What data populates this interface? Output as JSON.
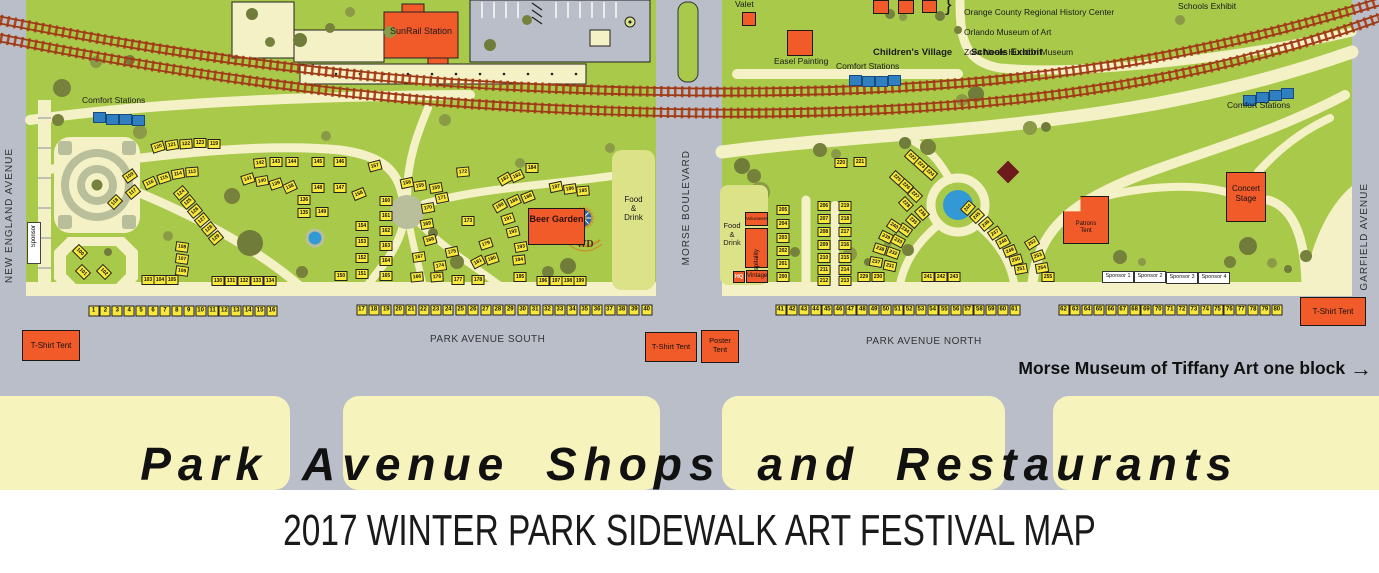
{
  "banner": "Park Avenue Shops and Restaurants",
  "subtitle": "2017 WINTER PARK SIDEWALK ART FESTIVAL MAP",
  "streets": {
    "new_england": "NEW ENGLAND AVENUE",
    "morse": "MORSE BOULEVARD",
    "garfield": "GARFIELD AVENUE",
    "park_south": "PARK AVENUE SOUTH",
    "park_north": "PARK AVENUE NORTH"
  },
  "note": {
    "text": "Morse Museum of Tiffany Art one block",
    "arrow": "→"
  },
  "museums": {
    "brace": "}",
    "line1": "Orange County Regional History Center",
    "line2": "Orlando Museum of Art",
    "line3": "Zora Neale Hurston Museum"
  },
  "labels": {
    "sunrail": "SunRail Station",
    "comfort": "Comfort Stations",
    "valet": "Valet",
    "easel": "Easel Painting",
    "childrens_village": "Children's Village",
    "schools_exhibit": "Schools Exhibit",
    "beer_garden": "Beer Garden",
    "wd": "WD",
    "food_drink": "Food\n&\nDrink",
    "volunteers": "Volunteers",
    "hospitality": "Hospitality",
    "hq": "HQ",
    "vintage": "Vintage",
    "patrons_tent": "Patrons\nTent",
    "concert_stage": "Concert\nStage",
    "tshirt_tent": "T-Shirt Tent",
    "poster_tent": "Poster\nTent",
    "sponsor_vertical": "Sponsor",
    "sponsors": [
      "Sponsor 1",
      "Sponsor 2",
      "Sponsor 3",
      "Sponsor 4"
    ]
  },
  "street_booths": [
    {
      "x": 93.5,
      "y": 311,
      "step": 11.9,
      "numbers": [
        1,
        2,
        3,
        4,
        5,
        6,
        7,
        8,
        9,
        10,
        11,
        12,
        13,
        14,
        15,
        16
      ]
    },
    {
      "x": 361.5,
      "y": 310,
      "step": 12.4,
      "numbers": [
        17,
        18,
        19,
        20,
        21,
        22,
        23,
        24,
        25,
        26,
        27,
        28,
        29,
        30,
        31,
        32,
        33,
        34,
        35,
        36,
        37,
        38,
        39,
        40
      ]
    },
    {
      "x": 780.5,
      "y": 310,
      "step": 11.7,
      "numbers": [
        41,
        42,
        43,
        44,
        45,
        46,
        47,
        48,
        49,
        50,
        51,
        52,
        53,
        54,
        55,
        56,
        57,
        58,
        59,
        60,
        61
      ]
    },
    {
      "x": 1063.5,
      "y": 310,
      "step": 11.85,
      "numbers": [
        62,
        63,
        64,
        65,
        66,
        67,
        68,
        69,
        70,
        71,
        72,
        73,
        74,
        75,
        76,
        77,
        78,
        79,
        80
      ]
    }
  ],
  "park_booths": [
    [
      100,
      80,
      252,
      45
    ],
    [
      101,
      83,
      272,
      45
    ],
    [
      102,
      104,
      272,
      45
    ],
    [
      103,
      148,
      280,
      0
    ],
    [
      104,
      160,
      280,
      0
    ],
    [
      105,
      172,
      280,
      0
    ],
    [
      106,
      182,
      271,
      8
    ],
    [
      107,
      182,
      259,
      8
    ],
    [
      108,
      182,
      247,
      8
    ],
    [
      109,
      130,
      176,
      -35
    ],
    [
      117,
      133,
      192,
      -40
    ],
    [
      118,
      115,
      202,
      -45
    ],
    [
      116,
      150,
      183,
      -25
    ],
    [
      115,
      164,
      178,
      -18
    ],
    [
      114,
      178,
      174,
      -10
    ],
    [
      113,
      192,
      172,
      -4
    ],
    [
      120,
      158,
      147,
      -18
    ],
    [
      121,
      172,
      145,
      -10
    ],
    [
      122,
      186,
      144,
      -4
    ],
    [
      123,
      200,
      143,
      0
    ],
    [
      119,
      214,
      144,
      0
    ],
    [
      124,
      181,
      193,
      -40
    ],
    [
      125,
      188,
      202,
      -40
    ],
    [
      126,
      195,
      211,
      -40
    ],
    [
      127,
      202,
      220,
      -40
    ],
    [
      128,
      209,
      229,
      -40
    ],
    [
      129,
      216,
      238,
      -40
    ],
    [
      130,
      218,
      281,
      0
    ],
    [
      131,
      231,
      281,
      0
    ],
    [
      132,
      244,
      281,
      0
    ],
    [
      133,
      257,
      281,
      0
    ],
    [
      134,
      270,
      281,
      0
    ],
    [
      141,
      248,
      179,
      -18
    ],
    [
      140,
      262,
      181,
      -10
    ],
    [
      139,
      276,
      184,
      -18
    ],
    [
      138,
      290,
      187,
      -25
    ],
    [
      142,
      260,
      163,
      -6
    ],
    [
      143,
      276,
      162,
      0
    ],
    [
      144,
      292,
      162,
      0
    ],
    [
      145,
      318,
      162,
      0
    ],
    [
      146,
      340,
      162,
      0
    ],
    [
      148,
      318,
      188,
      0
    ],
    [
      147,
      340,
      188,
      0
    ],
    [
      136,
      304,
      200,
      0
    ],
    [
      135,
      304,
      213,
      0
    ],
    [
      149,
      322,
      212,
      0
    ],
    [
      150,
      341,
      276,
      0
    ],
    [
      151,
      362,
      274,
      0
    ],
    [
      152,
      362,
      258,
      0
    ],
    [
      153,
      362,
      242,
      0
    ],
    [
      154,
      362,
      226,
      0
    ],
    [
      155,
      420,
      186,
      -8
    ],
    [
      156,
      407,
      183,
      -12
    ],
    [
      157,
      375,
      166,
      -15
    ],
    [
      158,
      359,
      194,
      -22
    ],
    [
      159,
      436,
      188,
      -10
    ],
    [
      160,
      386,
      201,
      0
    ],
    [
      161,
      386,
      216,
      0
    ],
    [
      162,
      386,
      231,
      0
    ],
    [
      163,
      386,
      246,
      0
    ],
    [
      164,
      386,
      261,
      0
    ],
    [
      165,
      386,
      276,
      0
    ],
    [
      166,
      417,
      277,
      -5
    ],
    [
      167,
      419,
      257,
      -8
    ],
    [
      168,
      430,
      240,
      -15
    ],
    [
      169,
      427,
      224,
      -10
    ],
    [
      170,
      428,
      208,
      -10
    ],
    [
      171,
      442,
      198,
      -12
    ],
    [
      172,
      463,
      172,
      -5
    ],
    [
      173,
      468,
      221,
      0
    ],
    [
      174,
      440,
      266,
      -8
    ],
    [
      175,
      452,
      252,
      -12
    ],
    [
      176,
      437,
      277,
      -4
    ],
    [
      177,
      458,
      280,
      0
    ],
    [
      178,
      478,
      280,
      0
    ],
    [
      179,
      486,
      244,
      -18
    ],
    [
      180,
      492,
      259,
      -18
    ],
    [
      181,
      478,
      262,
      -28
    ],
    [
      182,
      505,
      179,
      -30
    ],
    [
      183,
      517,
      176,
      -25
    ],
    [
      184,
      532,
      168,
      0
    ],
    [
      187,
      556,
      187,
      -12
    ],
    [
      186,
      570,
      189,
      -8
    ],
    [
      185,
      583,
      191,
      -5
    ],
    [
      190,
      500,
      206,
      -30
    ],
    [
      189,
      514,
      201,
      -25
    ],
    [
      188,
      528,
      197,
      -22
    ],
    [
      191,
      508,
      219,
      -18
    ],
    [
      192,
      513,
      232,
      -14
    ],
    [
      193,
      521,
      247,
      -10
    ],
    [
      194,
      519,
      260,
      -6
    ],
    [
      195,
      520,
      277,
      0
    ],
    [
      196,
      543,
      281,
      0
    ],
    [
      197,
      556,
      281,
      0
    ],
    [
      198,
      568,
      281,
      0
    ],
    [
      199,
      580,
      281,
      0
    ],
    [
      200,
      783,
      277,
      0
    ],
    [
      201,
      783,
      264,
      0
    ],
    [
      202,
      783,
      251,
      0
    ],
    [
      203,
      783,
      238,
      0
    ],
    [
      204,
      783,
      224,
      0
    ],
    [
      205,
      783,
      210,
      0
    ],
    [
      206,
      824,
      206,
      0
    ],
    [
      207,
      824,
      219,
      0
    ],
    [
      208,
      824,
      232,
      0
    ],
    [
      209,
      824,
      245,
      0
    ],
    [
      210,
      824,
      258,
      0
    ],
    [
      211,
      824,
      270,
      0
    ],
    [
      212,
      824,
      281,
      0
    ],
    [
      213,
      845,
      281,
      0
    ],
    [
      214,
      845,
      270,
      0
    ],
    [
      215,
      845,
      258,
      0
    ],
    [
      216,
      845,
      245,
      0
    ],
    [
      217,
      845,
      232,
      0
    ],
    [
      218,
      845,
      219,
      0
    ],
    [
      219,
      845,
      206,
      0
    ],
    [
      220,
      841,
      163,
      0
    ],
    [
      221,
      860,
      162,
      0
    ],
    [
      222,
      912,
      157,
      42
    ],
    [
      223,
      921,
      165,
      42
    ],
    [
      224,
      930,
      173,
      42
    ],
    [
      225,
      897,
      178,
      42
    ],
    [
      226,
      906,
      186,
      42
    ],
    [
      227,
      915,
      195,
      44
    ],
    [
      228,
      906,
      204,
      46
    ],
    [
      229,
      864,
      277,
      0
    ],
    [
      230,
      878,
      277,
      0
    ],
    [
      231,
      890,
      266,
      12
    ],
    [
      232,
      893,
      253,
      20
    ],
    [
      233,
      898,
      241,
      28
    ],
    [
      234,
      905,
      230,
      36
    ],
    [
      235,
      913,
      221,
      42
    ],
    [
      236,
      922,
      213,
      48
    ],
    [
      237,
      876,
      262,
      10
    ],
    [
      238,
      880,
      249,
      18
    ],
    [
      239,
      886,
      237,
      26
    ],
    [
      240,
      894,
      226,
      34
    ],
    [
      241,
      928,
      277,
      0
    ],
    [
      242,
      941,
      277,
      0
    ],
    [
      243,
      954,
      277,
      0
    ],
    [
      244,
      968,
      208,
      -48
    ],
    [
      245,
      977,
      216,
      -44
    ],
    [
      246,
      986,
      224,
      -40
    ],
    [
      247,
      995,
      233,
      -34
    ],
    [
      248,
      1003,
      242,
      -28
    ],
    [
      249,
      1010,
      251,
      -22
    ],
    [
      250,
      1016,
      260,
      -16
    ],
    [
      251,
      1021,
      269,
      -10
    ],
    [
      252,
      1032,
      243,
      -32
    ],
    [
      253,
      1038,
      256,
      -20
    ],
    [
      254,
      1042,
      268,
      -10
    ],
    [
      255,
      1048,
      277,
      0
    ]
  ],
  "trees": [
    [
      62,
      88,
      9
    ],
    [
      96,
      62,
      6
    ],
    [
      130,
      60,
      5
    ],
    [
      58,
      120,
      6
    ],
    [
      140,
      132,
      7
    ],
    [
      250,
      243,
      13
    ],
    [
      232,
      196,
      8
    ],
    [
      168,
      236,
      5
    ],
    [
      108,
      252,
      4
    ],
    [
      302,
      272,
      6
    ],
    [
      326,
      136,
      5
    ],
    [
      433,
      233,
      5
    ],
    [
      457,
      262,
      7
    ],
    [
      520,
      163,
      5
    ],
    [
      568,
      266,
      8
    ],
    [
      548,
      272,
      6
    ],
    [
      610,
      148,
      5
    ],
    [
      300,
      40,
      7
    ],
    [
      330,
      28,
      5
    ],
    [
      390,
      32,
      6
    ],
    [
      490,
      45,
      6
    ],
    [
      527,
      20,
      5
    ],
    [
      350,
      12,
      5
    ],
    [
      252,
      14,
      6
    ],
    [
      270,
      42,
      5
    ],
    [
      445,
      120,
      6
    ],
    [
      742,
      166,
      8
    ],
    [
      754,
      176,
      7
    ],
    [
      760,
      192,
      10
    ],
    [
      734,
      196,
      6
    ],
    [
      820,
      150,
      7
    ],
    [
      836,
      154,
      5
    ],
    [
      905,
      143,
      6
    ],
    [
      928,
      147,
      8
    ],
    [
      1030,
      128,
      7
    ],
    [
      1046,
      127,
      5
    ],
    [
      795,
      252,
      5
    ],
    [
      850,
      254,
      7
    ],
    [
      868,
      262,
      4
    ],
    [
      908,
      250,
      6
    ],
    [
      888,
      243,
      4
    ],
    [
      1092,
      236,
      5
    ],
    [
      1120,
      257,
      7
    ],
    [
      1142,
      262,
      4
    ],
    [
      1248,
      246,
      9
    ],
    [
      1230,
      262,
      6
    ],
    [
      1272,
      263,
      5
    ],
    [
      1288,
      269,
      4
    ],
    [
      1306,
      256,
      6
    ],
    [
      962,
      100,
      6
    ],
    [
      976,
      94,
      8
    ],
    [
      890,
      14,
      5
    ],
    [
      903,
      17,
      4
    ],
    [
      940,
      16,
      5
    ],
    [
      958,
      30,
      4
    ],
    [
      1180,
      20,
      5
    ]
  ],
  "comfort_groups": [
    {
      "squares": [
        [
          93,
          112
        ],
        [
          106,
          114
        ],
        [
          119,
          114
        ],
        [
          132,
          115
        ]
      ]
    },
    {
      "squares": [
        [
          849,
          75
        ],
        [
          862,
          76
        ],
        [
          875,
          76
        ],
        [
          888,
          75
        ]
      ]
    },
    {
      "squares": [
        [
          1243,
          95
        ],
        [
          1256,
          92
        ],
        [
          1269,
          90
        ],
        [
          1281,
          88
        ]
      ]
    }
  ],
  "colors": {
    "orange": "#f15a29",
    "booth_yellow": "#f8e83b",
    "comfort_blue": "#2f7fc1",
    "park_green": "#a9c94b",
    "path_cream": "#f3f1c5",
    "street_gray": "#b9bec8",
    "shops_band": "#f7f3bd",
    "panel_green": "#dce287",
    "rail_rust": "#b0471f",
    "maroon": "#6d1a1d"
  }
}
